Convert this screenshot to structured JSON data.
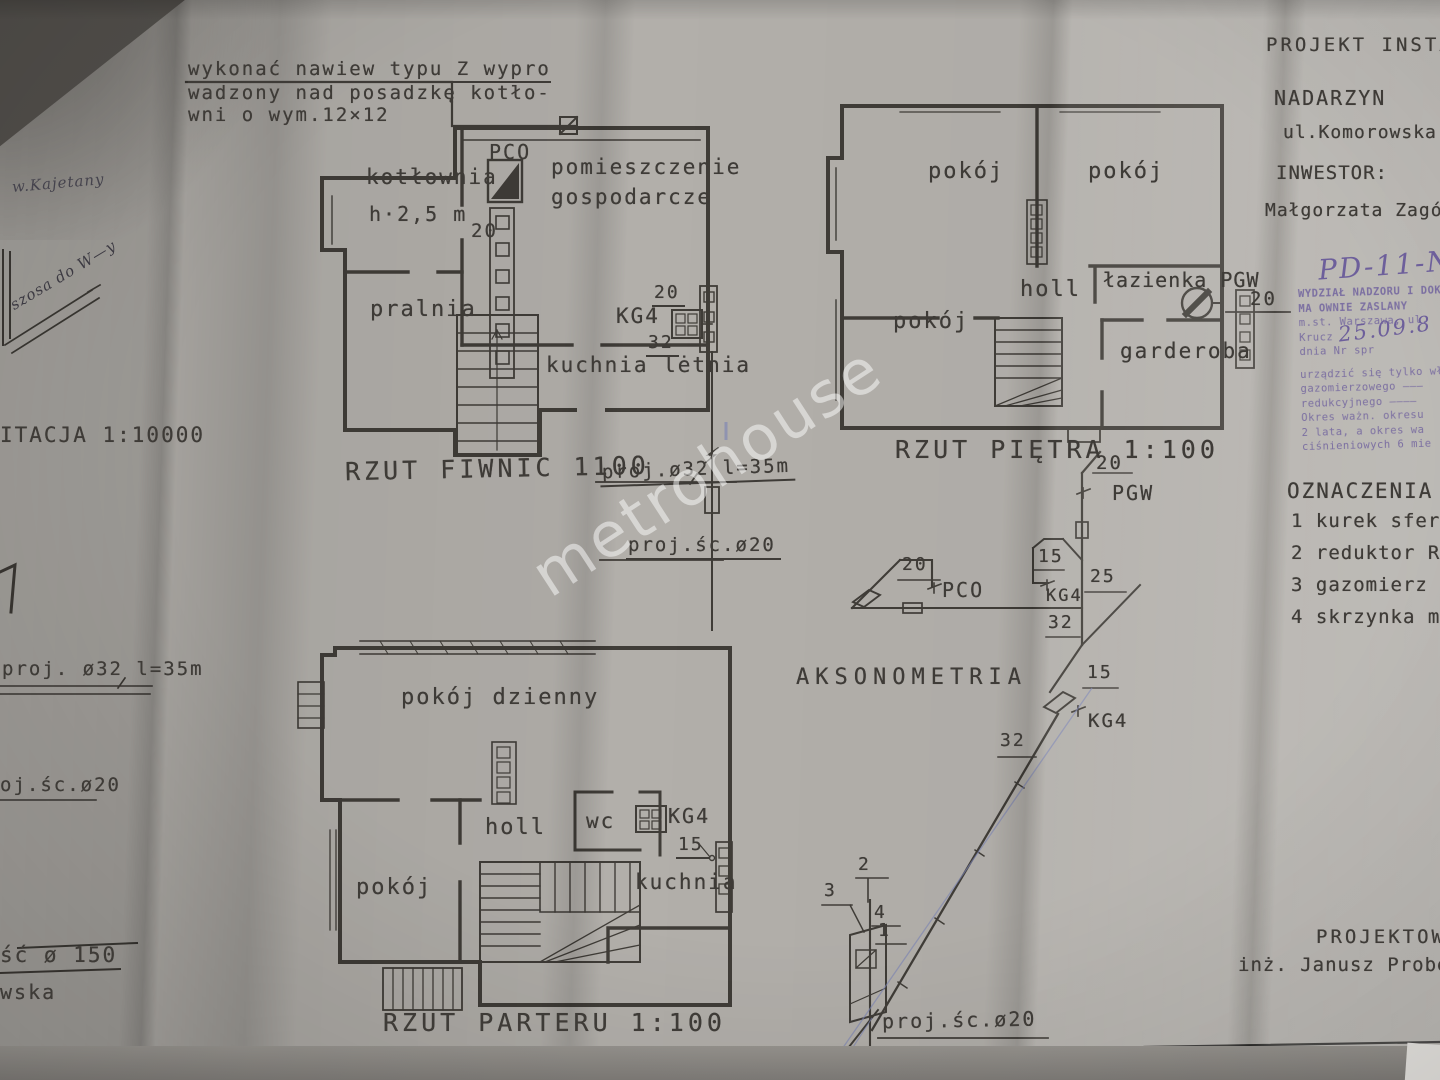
{
  "watermark": "metrohouse",
  "topnote": {
    "l1": "wykonać nawiew typu Z wypro",
    "l2": "wadzony nad posadzkę kotło-",
    "l3": "wni o wym.12×12"
  },
  "titleblock": {
    "project": "PROJEKT  INSTALAC",
    "city": "NADARZYN",
    "street": "ul.Komorowska 1",
    "investor_label": "INWESTOR:",
    "investor": "Małgorzata  Zagórs"
  },
  "stamp": {
    "code": "PD-11-NN",
    "date": "25.09.8",
    "lines": [
      "WYDZIAŁ NADZORU I DOK",
      "MA OWNIE ZASLANY",
      "m.st. Warszawa, ul. Krucz",
      "dnia          Nr spr",
      "urządzić się tylko wła",
      "gazomierzowego ———",
      "redukcyjnego ————",
      "Okres ważn. okresu",
      "2 lata, a okres wa",
      "ciśnieniowych 6 mie"
    ]
  },
  "legend": {
    "title": "OZNACZENIA",
    "items": [
      "1 kurek sferyczny GA",
      "2 reduktor RG10",
      "3 gazomierz  4G-6",
      "4 skrzynka  metalow"
    ]
  },
  "footer": {
    "role": "PROJEKTOWA",
    "name": "inż. Janusz  Probe st558"
  },
  "basement": {
    "caption": "RZUT  FIWNIC  1100",
    "kotlownia": "kotłownia",
    "height": "h·2,5 m",
    "pco": "PCO",
    "gosp1": "pomieszczenie",
    "gosp2": "gospodarcze",
    "pralnia": "pralnia",
    "kg": "KG4",
    "kuchnia": "kuchnia lėtnia",
    "d20a": "20",
    "d20b": "20",
    "d32": "32"
  },
  "floor": {
    "caption": "RZUT  PIĘTRA  1:100",
    "pokoj1": "pokój",
    "pokoj2": "pokój",
    "holl": "holl",
    "lazienka": "łazienka PGW",
    "pokoj3": "pokój",
    "garderoba": "garderoba",
    "d20": "20"
  },
  "ground": {
    "caption": "RZUT  PARTERU  1:100",
    "dzienny": "pokój dzienny",
    "holl": "holl",
    "wc": "wc",
    "kg": "KG4",
    "d15": "15",
    "kuchnia": "kuchnia",
    "pokoj": "pokój"
  },
  "axo": {
    "title": "AKSONOMETRIA",
    "pgw": "PGW",
    "pco": "PCO",
    "kg_a": "KG4",
    "kg_b": "KG4",
    "d20_top": "20",
    "d20_pco": "20",
    "d15_left": "15",
    "d15_right": "15",
    "d25": "25",
    "d32_a": "32",
    "d32_b": "32",
    "n1": "1",
    "n2": "2",
    "n3": "3",
    "n4": "4",
    "proj20": "proj.śc.ø20"
  },
  "pipes": {
    "proj32": "proj.ø32 l=35m",
    "proj20": "proj.śc.ø20"
  },
  "leftmargin": {
    "kajetany": "w.Kajetany",
    "szosa": "szosa do W—y",
    "situacja": "ITACJA  1:10000",
    "proj32": "proj. ø32 l=35m",
    "proj20": "oj.śc.ø20",
    "d150": "ść ø 150",
    "wska": "wska"
  }
}
